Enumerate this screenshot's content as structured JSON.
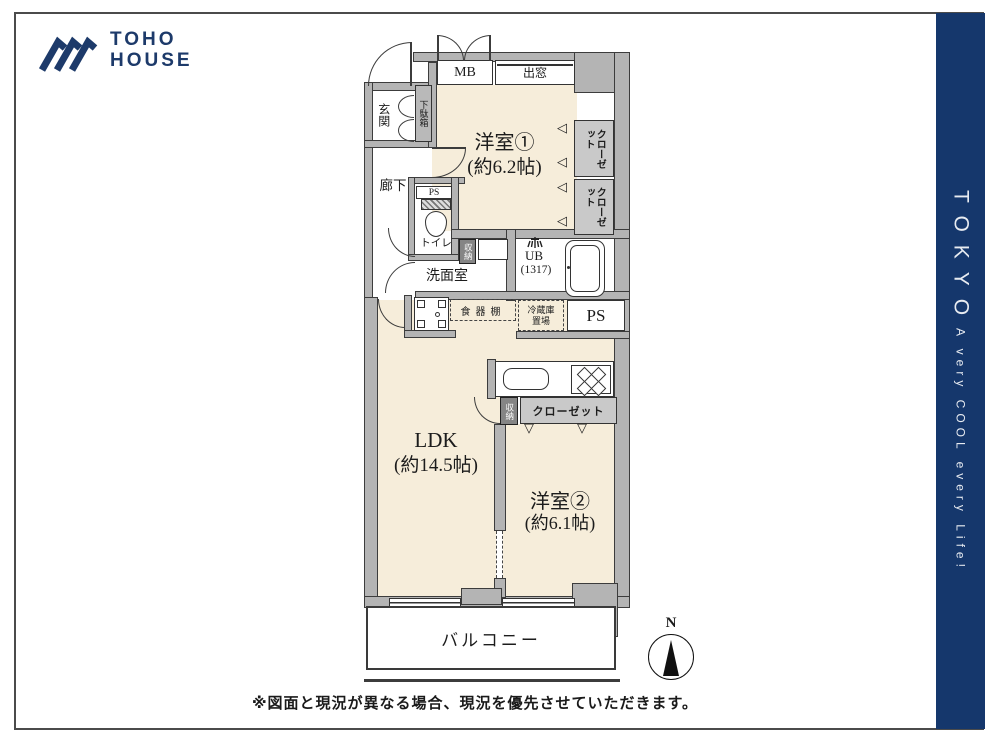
{
  "brand": {
    "line1": "TOHO",
    "line2": "HOUSE"
  },
  "side_banner": {
    "city": "TOKYO",
    "tagline": "A very COOL every Life!"
  },
  "colors": {
    "navy": "#15376c",
    "room_fill": "#f6edda",
    "wall_fill": "#b4b4b4",
    "line": "#3c3c3c"
  },
  "floorplan": {
    "western1": {
      "name": "洋室①",
      "size": "(約6.2帖)"
    },
    "western2": {
      "name": "洋室②",
      "size": "(約6.1帖)"
    },
    "ldk": {
      "name": "LDK",
      "size": "(約14.5帖)"
    },
    "balcony": "バルコニー",
    "entrance": "玄関",
    "corridor": "廊下",
    "toilet": "トイレ",
    "washroom": "洗面室",
    "bath": {
      "name": "UB",
      "size": "(1317)"
    },
    "mb": "MB",
    "bay_window": "出窓",
    "shoe_cabinet": "下駄箱",
    "closet": "クローゼット",
    "storage": "収納",
    "ps": "PS",
    "cupboard": "食器棚",
    "fridge": "冷蔵庫置場",
    "compass_n": "N",
    "icons": {
      "fold_left": "◁",
      "fold_down": "▽"
    }
  },
  "footer": {
    "disclaimer": "※図面と現況が異なる場合、現況を優先させていただきます。"
  }
}
